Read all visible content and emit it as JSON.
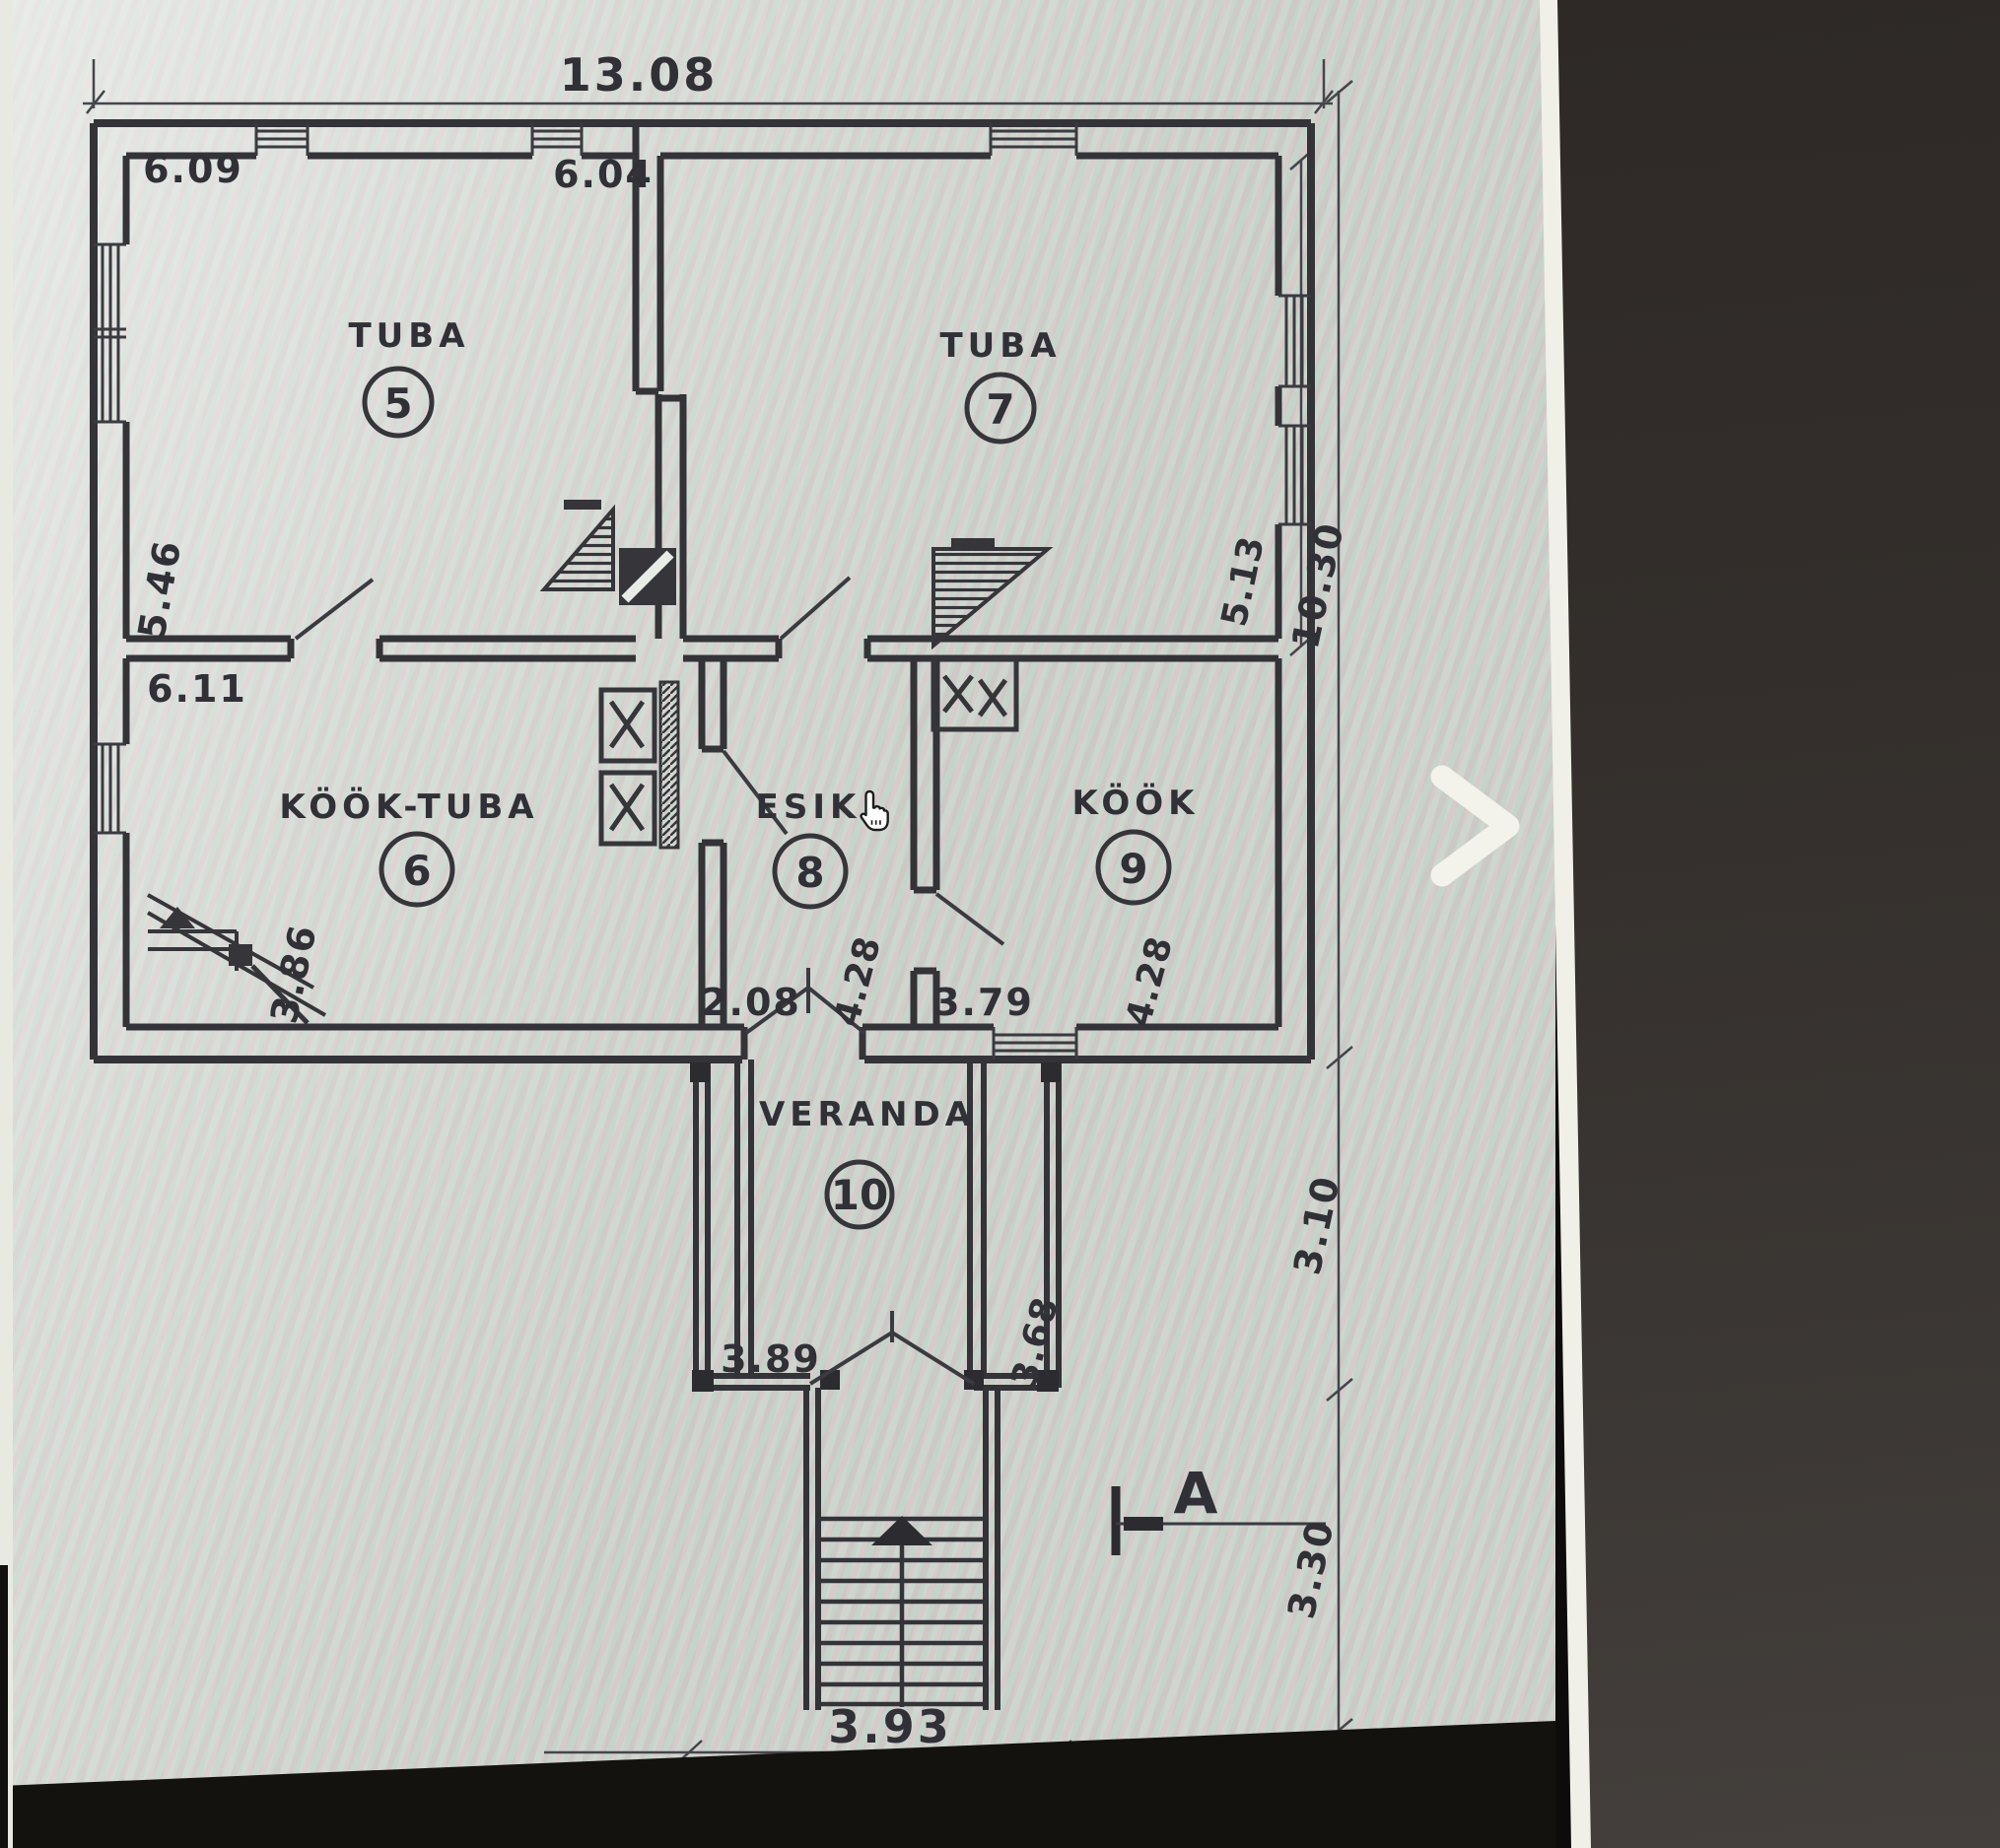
{
  "viewer": {
    "next_arrow": "›",
    "colors": {
      "paper": "#c9cfc8",
      "ink": "#35353a",
      "side_panel": "#332e2b",
      "bottom_band": "#14120f",
      "chevron": "#f3f3ec"
    }
  },
  "plan": {
    "rooms": [
      {
        "name": "TUBA",
        "number": "5"
      },
      {
        "name": "TUBA",
        "number": "7"
      },
      {
        "name": "KÖÖK-TUBA",
        "number": "6"
      },
      {
        "name": "ESIK",
        "number": "8"
      },
      {
        "name": "KÖÖK",
        "number": "9"
      },
      {
        "name": "VERANDA",
        "number": "10"
      }
    ],
    "dims": {
      "top_total": "13.08",
      "room5_width": "6.09",
      "room7_width": "6.04",
      "room5_height": "5.46",
      "room6_width": "6.11",
      "room6_height": "3.86",
      "room7_height": "5.13",
      "total_depth": "10.30",
      "esik_width": "2.08",
      "esik_depth": "4.28",
      "kook_width": "3.79",
      "kook_depth": "4.28",
      "veranda_offset": "3.10",
      "steps_offset": "3.30",
      "veranda_width": "3.89",
      "veranda_depth": "3.68",
      "steps_width": "3.93"
    },
    "section_label": "A"
  }
}
